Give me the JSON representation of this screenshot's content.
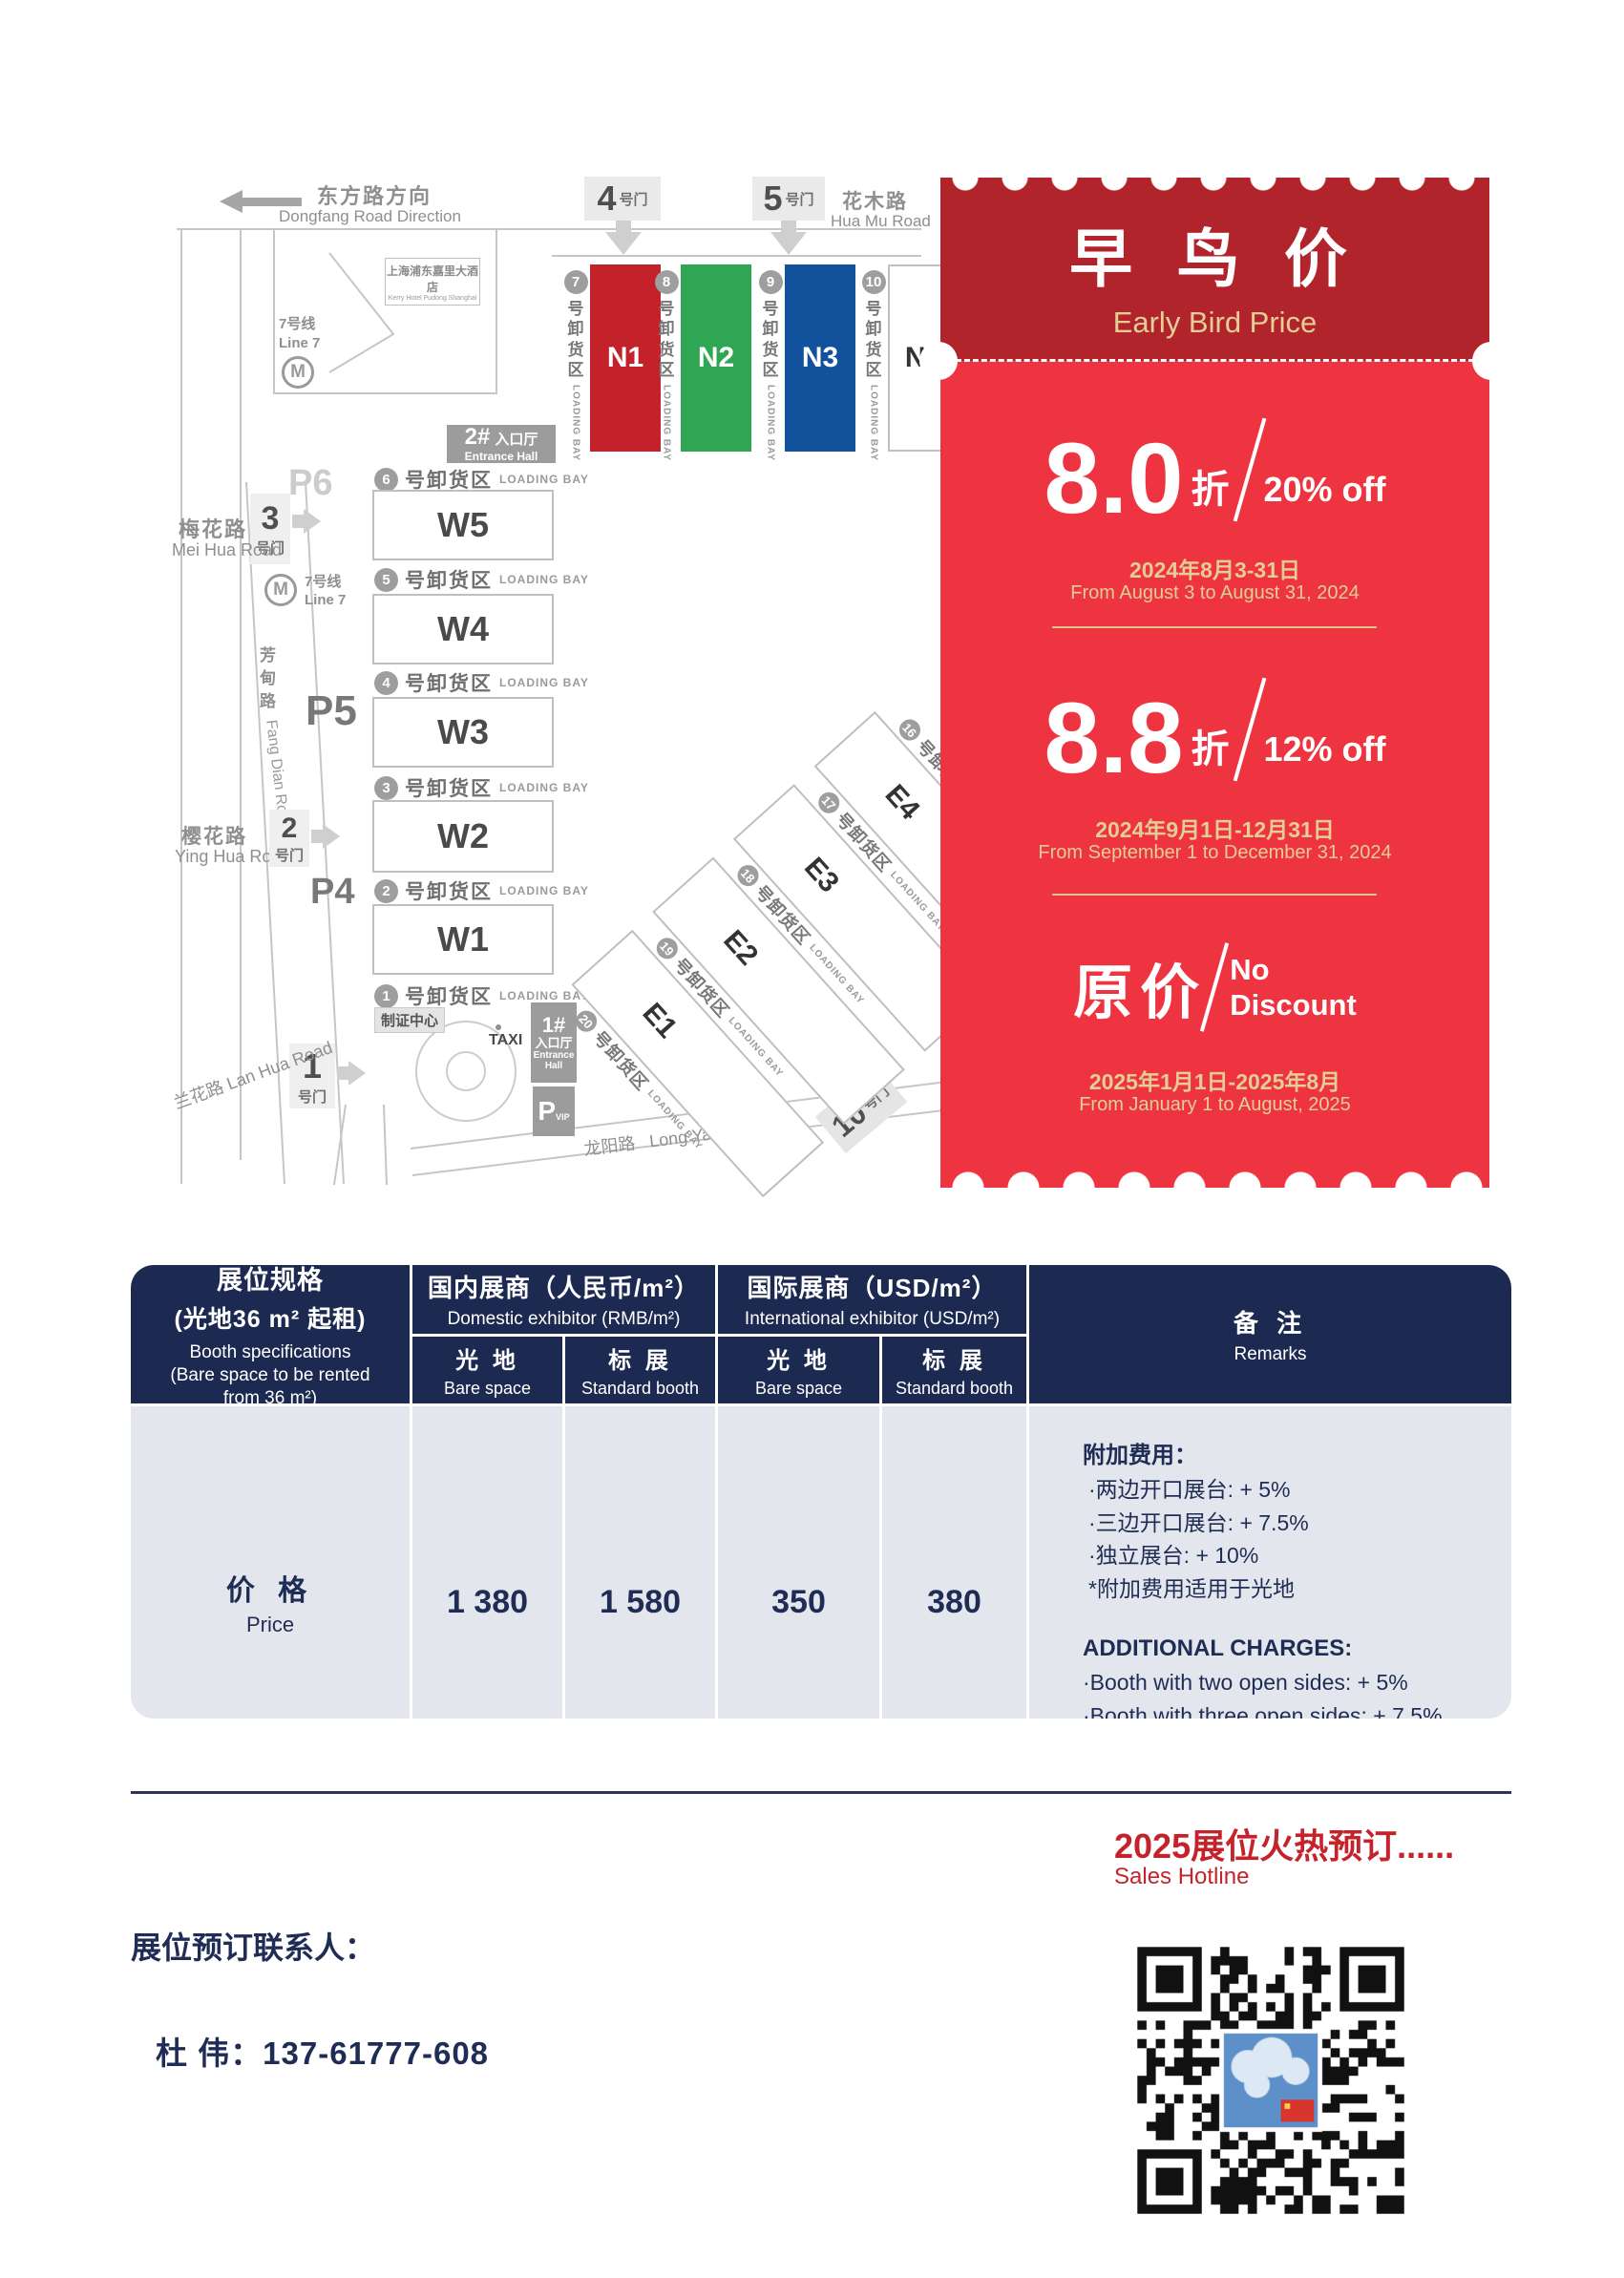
{
  "map": {
    "gate_suffix": "号门",
    "loading": {
      "zh": "号卸货区",
      "en": "LOADING BAY"
    },
    "roads": {
      "dongfang_zh": "东方路方向",
      "dongfang_en": "Dongfang Road Direction",
      "huamu_zh": "花木路",
      "huamu_en": "Hua Mu Road",
      "meihua_zh": "梅花路",
      "meihua_en": "Mei Hua Road",
      "yinghua_zh": "樱花路",
      "yinghua_en": "Ying Hua Road",
      "lanhua": "兰花路 Lan Hua Road",
      "fangdian_zh": "芳甸路",
      "fangdian_en": "Fang Dian Road",
      "longyang_zh": "龙阳路",
      "longyang_en": "Long Yang Road"
    },
    "metro": {
      "line_zh": "7号线",
      "line_en": "Line 7",
      "icon": "M"
    },
    "hotel": {
      "zh": "上海浦东嘉里大酒店",
      "en": "Kerry Hotel Pudong Shanghai"
    },
    "gates": {
      "g1": "1",
      "g2": "2",
      "g3": "3",
      "g4": "4",
      "g5": "5",
      "g10": "10"
    },
    "parking": {
      "p4": "P4",
      "p5": "P5",
      "p6": "P6",
      "vip_p": "P",
      "vip_sub": "VIP"
    },
    "entrance1": {
      "num": "1#",
      "zh": "入口厅",
      "en1": "Entrance",
      "en2": "Hall"
    },
    "entrance2": {
      "num": "2#",
      "zh": "入口厅",
      "en": "Entrance Hall"
    },
    "badge_center": "制证中心",
    "taxi": "TAXI",
    "n_bays": [
      "7",
      "8",
      "9",
      "10"
    ],
    "n_halls": [
      "N1",
      "N2",
      "N3",
      "N4"
    ],
    "n_colors": [
      "#C4222B",
      "#2FA653",
      "#12529C",
      "#FFFFFF"
    ],
    "w_bays": [
      "6",
      "5",
      "4",
      "3",
      "2",
      "1"
    ],
    "w_halls": [
      "W5",
      "W4",
      "W3",
      "W2",
      "W1"
    ],
    "e_bays": [
      "16",
      "17",
      "18",
      "19",
      "20"
    ],
    "e_halls": [
      "E4",
      "E3",
      "E2",
      "E1"
    ]
  },
  "ticket": {
    "title_zh": "早 鸟 价",
    "title_en": "Early Bird Price",
    "tier1": {
      "big": "8.0",
      "unit": "折",
      "pct": "20% off",
      "date_zh": "2024年8月3-31日",
      "date_en": "From August 3 to August 31, 2024"
    },
    "tier2": {
      "big": "8.8",
      "unit": "折",
      "pct": "12% off",
      "date_zh": "2024年9月1日-12月31日",
      "date_en": "From September 1 to December 31, 2024"
    },
    "tier3": {
      "big": "原价",
      "line1": "No",
      "line2": "Discount",
      "date_zh": "2025年1月1日-2025年8月",
      "date_en": "From January 1 to August, 2025"
    },
    "colors": {
      "dark_red": "#B2242B",
      "red": "#EE3440",
      "gold": "#E3CE96"
    }
  },
  "table": {
    "spec": {
      "zh1": "展位规格",
      "zh2": "(光地36 m² 起租)",
      "en1": "Booth specifications",
      "en2": "(Bare space to be rented",
      "en3": "from 36 m²)"
    },
    "domestic": {
      "zh": "国内展商（人民币/m²）",
      "en": "Domestic exhibitor (RMB/m²)"
    },
    "international": {
      "zh": "国际展商（USD/m²）",
      "en": "International exhibitor (USD/m²)"
    },
    "remarks": {
      "zh": "备 注",
      "en": "Remarks"
    },
    "sub": {
      "bare_zh": "光 地",
      "bare_en": "Bare space",
      "std_zh": "标 展",
      "std_en": "Standard booth"
    },
    "price": {
      "zh": "价 格",
      "en": "Price",
      "dom_bare": "1 380",
      "dom_std": "1 580",
      "intl_bare": "350",
      "intl_std": "380"
    },
    "notes": {
      "zh_title": "附加费用：",
      "zh1": "·两边开口展台: + 5%",
      "zh2": "·三边开口展台: + 7.5%",
      "zh3": "·独立展台: + 10%",
      "zh4": "*附加费用适用于光地",
      "en_title": "ADDITIONAL CHARGES:",
      "en1": "·Booth with two open sides: + 5%",
      "en2": "·Booth with three open sides: + 7.5%",
      "en3": "·Independent booth: + 10%",
      "en4": "*Additional charges apply to bare space"
    }
  },
  "footer": {
    "hotline_zh": "2025展位火热预订......",
    "hotline_en": "Sales Hotline",
    "contact_label": "展位预订联系人：",
    "contact_name": "杜  伟：",
    "contact_phone": "137-61777-608"
  }
}
